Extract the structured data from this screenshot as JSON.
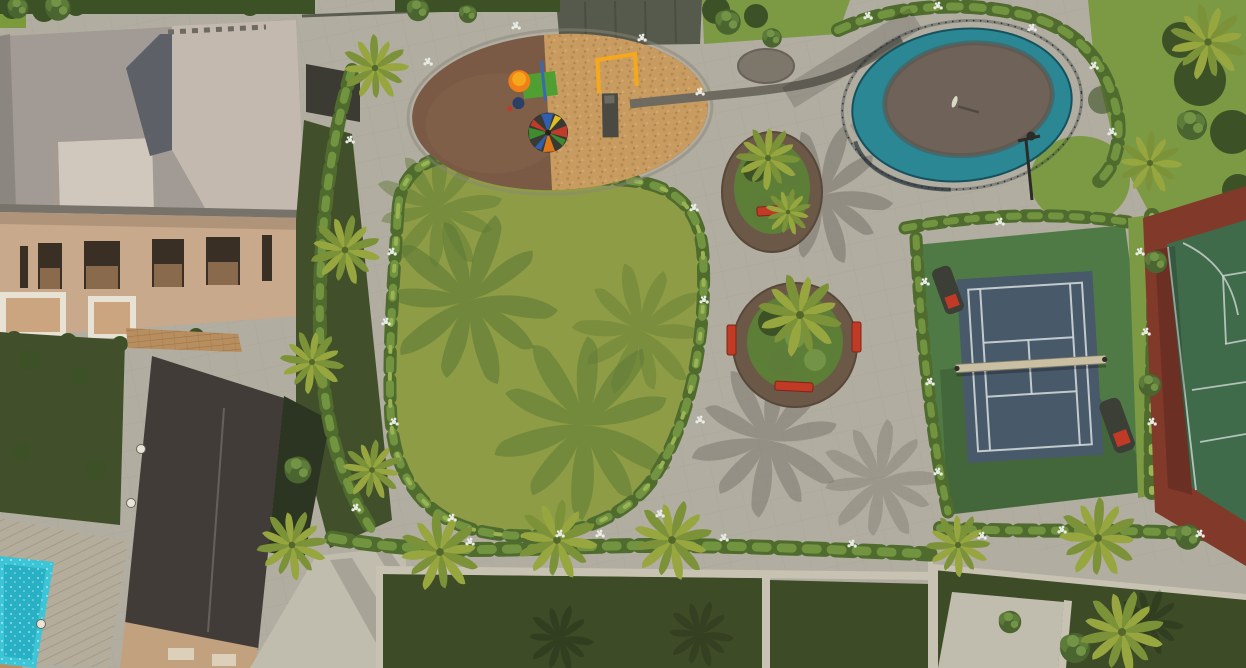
{
  "scene": {
    "title": "Aerial 3D render of a residential community amenity park",
    "view": "top-down aerial rendering, no text overlays",
    "areas": {
      "main_building": {
        "label": "beige clubhouse / villa with gray flat roof, roof box and dark windows",
        "position": "top-left"
      },
      "annex_building": {
        "label": "dark flat-roofed annex with tan base wall",
        "position": "left-bottom"
      },
      "private_garden": {
        "label": "dark green backyard lawn with white planter pots",
        "position": "left"
      },
      "wood_deck": {
        "label": "plank timber deck",
        "position": "bottom-left"
      },
      "private_pool": {
        "label": "turquoise swimming pool",
        "position": "bottom-left corner"
      },
      "playground": {
        "label": "oval playground, brown rubber + woodchip halves, tower slide, multicolor carousel, swing-slide unit",
        "position": "top-center-left"
      },
      "central_lawn": {
        "label": "large kidney-shaped lawn with palm shadows, ringed by gray path and shrub borders",
        "position": "center-left"
      },
      "plaza": {
        "label": "gray paved plaza with dark inlay circle and curved dark band",
        "position": "center"
      },
      "planter_islands": {
        "label": "two circular planting islands with palms and red benches",
        "count": 2
      },
      "splash_pool": {
        "label": "oval splash/wading pool with teal ring, dark center, safety railing, one person, light pole",
        "position": "top-right of plaza"
      },
      "tennis_court": {
        "label": "blue-gray tennis court with white lines, net and two dark shelters with red seats, on green apron",
        "position": "right"
      },
      "basketball_court": {
        "label": "green multi-sport court with white markings and terracotta border, cropped by right edge",
        "position": "far right"
      },
      "residential_plots": {
        "label": "dark green fenced backyard plots separated by light walls",
        "position": "bottom"
      },
      "driveway": {
        "label": "light concrete drive / footpaths",
        "position": "bottom-center-left"
      },
      "perimeter_fence": {
        "label": "dark boundary wall / mesh fence",
        "position": "top edge"
      }
    },
    "vegetation": {
      "palm_trees": 16,
      "round_trees": 13,
      "flower_clusters": 34,
      "shrub_borders": "white-flowering shrub lines along every path edge"
    },
    "furniture": {
      "red_benches": 4,
      "court_shelters": 2,
      "planter_pots": 3,
      "light_poles": 1
    }
  },
  "palette": {
    "basePaving": "#b1ada0",
    "lawn": "#8e9c45",
    "lawnShadow": "#5e7a35",
    "shrubDark": "#4f6b2e",
    "shrubMid": "#729441",
    "shrubMidF": "#7c9a44",
    "shrubLight": "#9ab353",
    "flowerWhite": "#e9ece6",
    "treeDark": "#3c5226",
    "gardenDark": "#41502a",
    "plotGreen": "#3d4b27",
    "wallLight": "#c7c2b2",
    "mulch": "#6b5847",
    "woodchip": "#c89b60",
    "rubber": "#7b5a45",
    "teal": "#2b8794",
    "splashCenter": "#6e6259",
    "fenceDark": "#2c343a",
    "tennisCourt": "#48596a",
    "courtLine": "#cfd6d8",
    "netBand": "#c9bfa3",
    "apron": "#4f7a45",
    "bballGreen": "#3f6b4b",
    "bballBorder": "#81392a",
    "benchRed": "#c03a26",
    "playYellow": "#f5a81c",
    "playOrange": "#ef7f16",
    "playGreen": "#4f9f33",
    "playBlue": "#3a68b2",
    "slideDark": "#4a4a42",
    "buildingWall": "#c9a98b",
    "buildingWallShade": "#ab8a6b",
    "roofGray": "#a29a94",
    "roofLight": "#c3b9af",
    "roofBox": "#d0c7bd",
    "roofNotch": "#5d6066",
    "windowDark": "#3a2f24",
    "annexRoof": "#413c37",
    "annexWall": "#c2a27e",
    "deckWood": "#b5ad9c",
    "poolWater": "#3cc5d6",
    "poolDeep": "#18a0b8",
    "clayTile": "#b98e5f",
    "concrete": "#c0bcae",
    "pathBand": "#6e6a60",
    "plazaInlay": "#7d766a",
    "fenceWall": "#565a4c",
    "frond1": "#97a63e",
    "frond2": "#7c9238",
    "frondCore": "#55682c"
  }
}
